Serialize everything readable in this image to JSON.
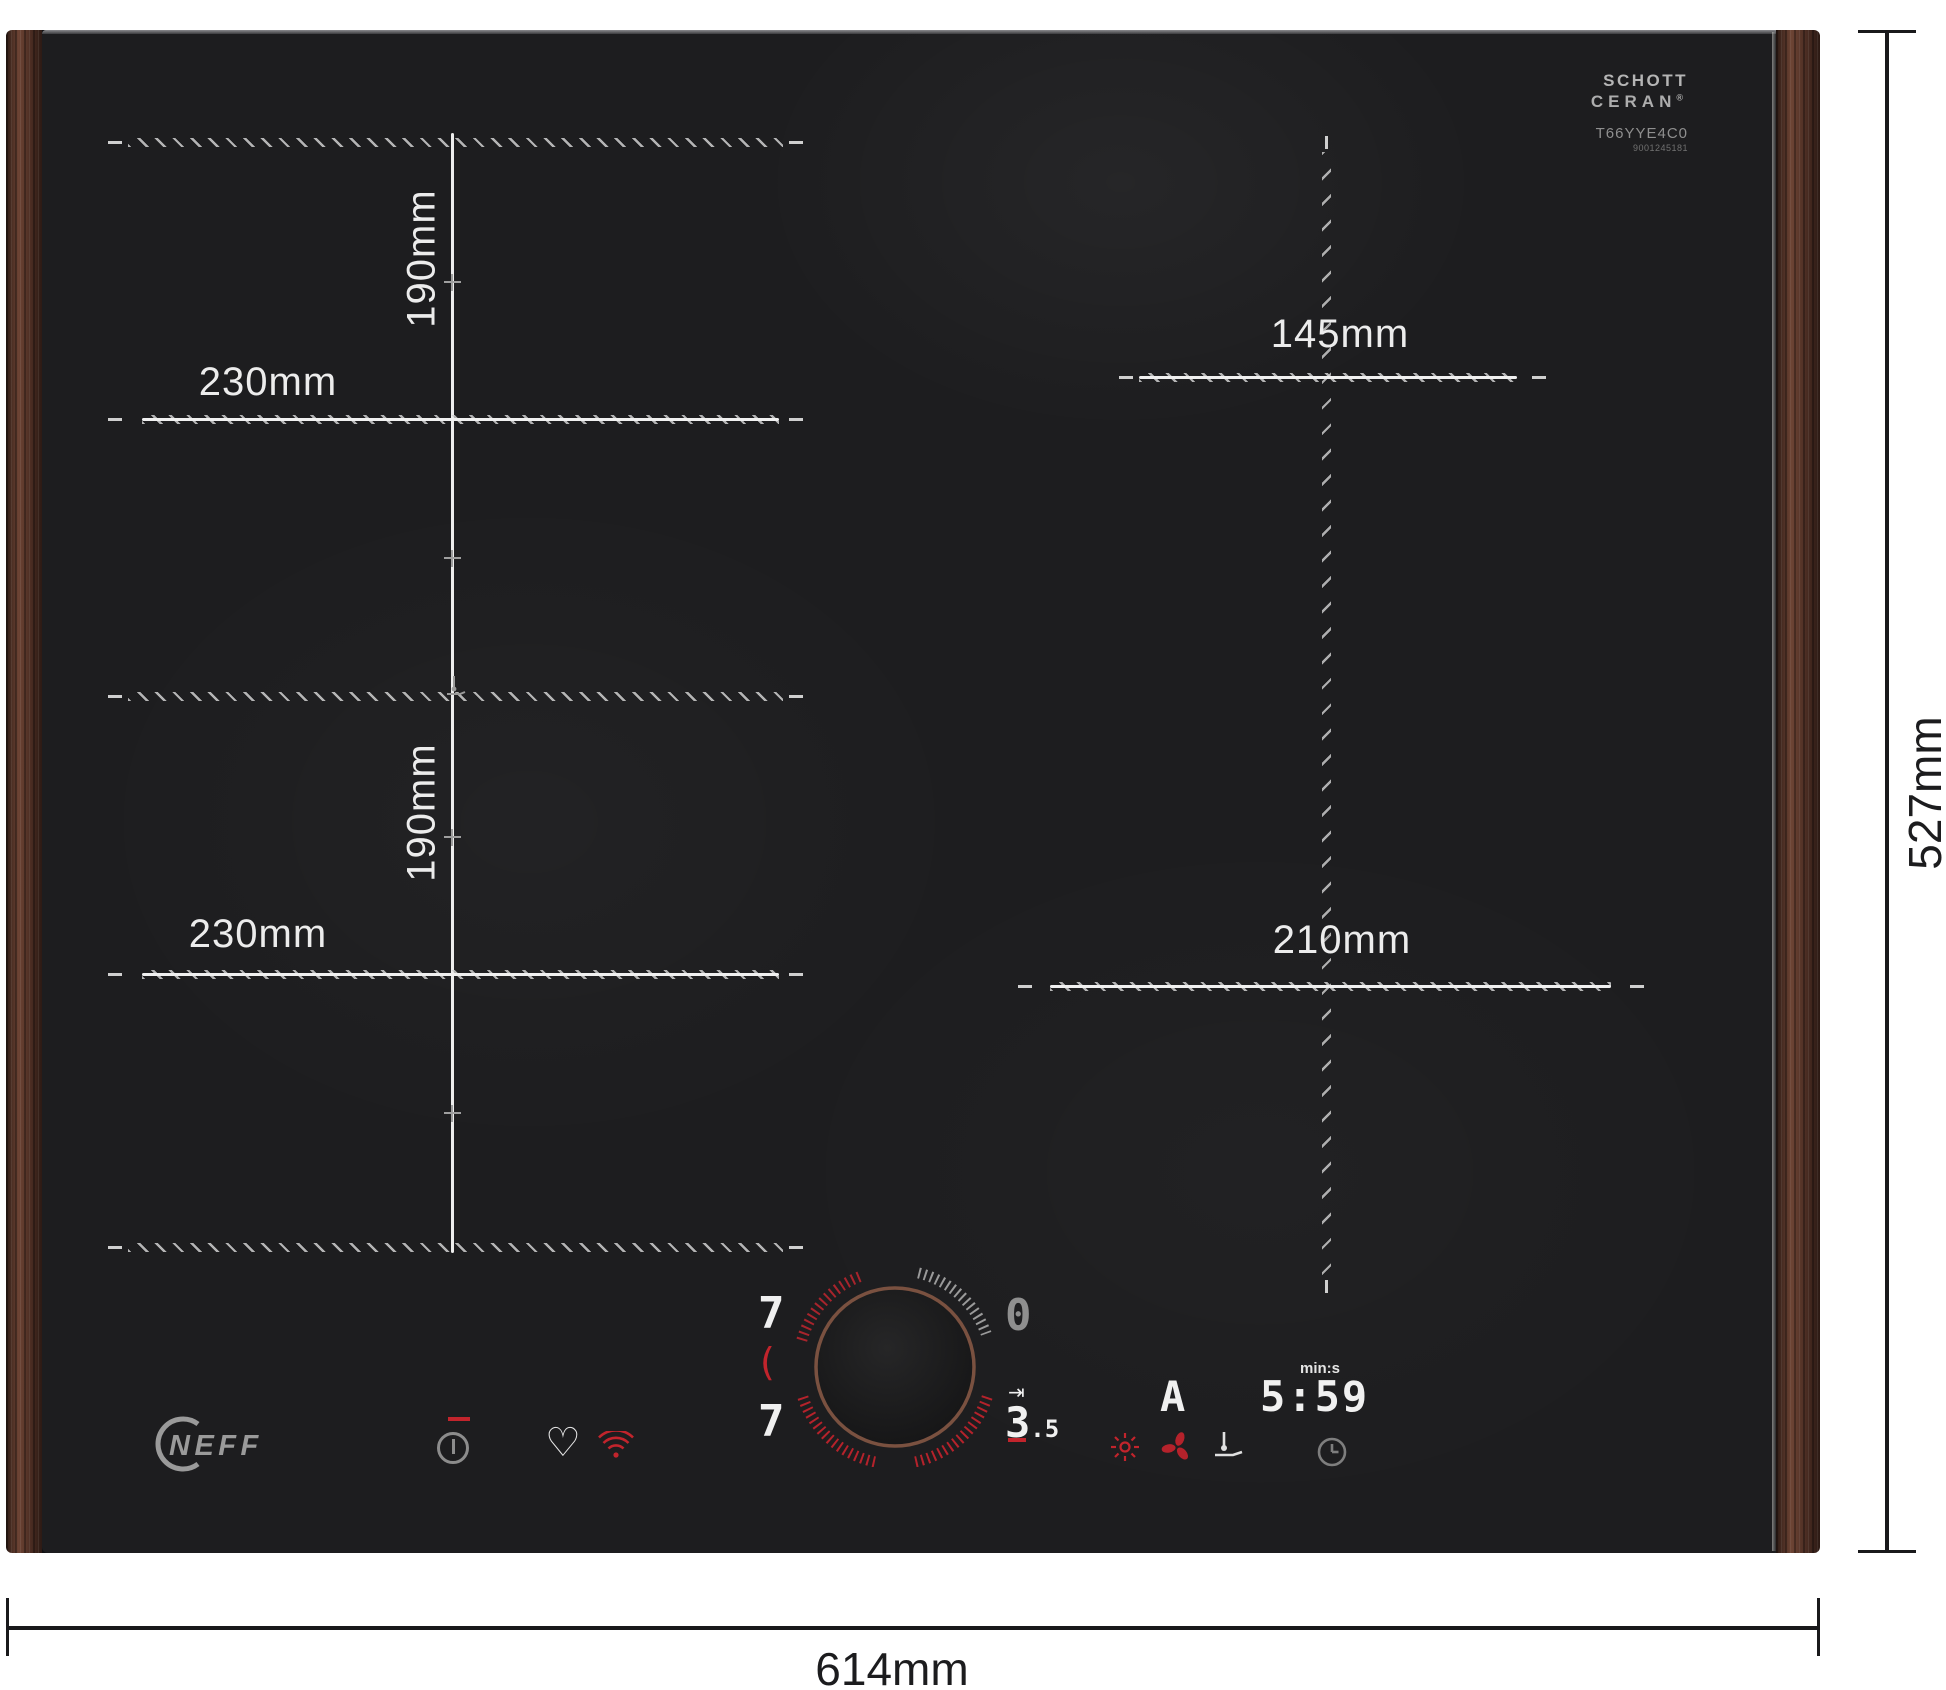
{
  "branding": {
    "neff_logo": "NEFF",
    "schott_line1": "SCHOTT",
    "schott_line2": "CERAN",
    "schott_reg": "®",
    "model_number": "T66YYE4C0",
    "serial_number": "9001245181"
  },
  "outer_dimensions": {
    "width": "614mm",
    "height": "527mm"
  },
  "zone_dimensions": {
    "left_top_width": "230mm",
    "left_top_height": "190mm",
    "left_bottom_width": "230mm",
    "left_bottom_height": "190mm",
    "right_top_diameter": "145mm",
    "right_bottom_diameter": "210mm"
  },
  "control_panel": {
    "left_zone_top_level": "7",
    "zone_select_bracket": "(",
    "left_zone_bottom_level": "7",
    "right_zone_top_level": "0",
    "bridge_symbol": "⇥",
    "right_zone_bottom_int": "3",
    "right_zone_bottom_dec": ".5",
    "auto_indicator": "A",
    "timer_unit": "min:s",
    "timer_value": "5:59"
  },
  "icons": {
    "power": "power-standby-icon",
    "favorite": "heart-icon",
    "wifi": "wifi-icon",
    "light": "sun-icon",
    "fan": "fan-icon",
    "probe": "temperature-probe-pan-icon",
    "timer": "clock-icon",
    "zone_join": "pan-probe-junction-icon"
  },
  "colors": {
    "accent_red": "#c2242c",
    "segment_white": "#f0f0f0",
    "segment_gray": "#8f8f8f",
    "knob_copper": "#7a5140",
    "glass": "#1d1d1f",
    "wood": "#4e2f26"
  }
}
